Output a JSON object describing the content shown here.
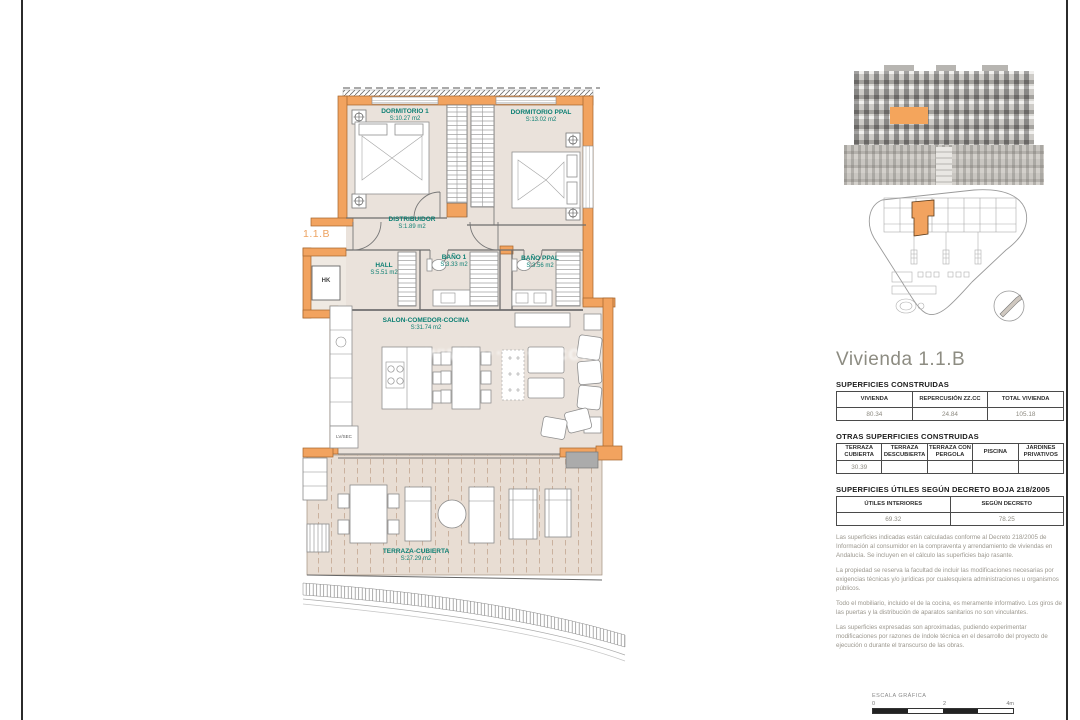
{
  "plan": {
    "unit_label": "1.1.B",
    "watermark": "www.·········.com",
    "rooms": [
      {
        "name": "DORMITORIO 1",
        "area": "S:10.27 m2"
      },
      {
        "name": "DORMITORIO PPAL",
        "area": "S:13.02 m2"
      },
      {
        "name": "DISTRIBUIDOR",
        "area": "S:1.89 m2"
      },
      {
        "name": "HALL",
        "area": "S:5.51 m2"
      },
      {
        "name": "BAÑO 1",
        "area": "S:3.33 m2"
      },
      {
        "name": "BAÑO PPAL",
        "area": "S:3.56 m2"
      },
      {
        "name": "SALON-COMEDOR-COCINA",
        "area": "S:31.74 m2"
      },
      {
        "name": "TERRAZA-CUBIERTA",
        "area": "S:27.29 m2"
      }
    ],
    "fixtures": {
      "hk": "HK",
      "lvsec": "LV/SEC"
    }
  },
  "panel": {
    "title": "Vivienda 1.1.B",
    "constructed": {
      "heading": "SUPERFICIES CONSTRUIDAS",
      "headers": [
        "VIVIENDA",
        "REPERCUSIÓN ZZ.CC",
        "TOTAL VIVIENDA"
      ],
      "values": [
        "80.34",
        "24.84",
        "105.18"
      ]
    },
    "other": {
      "heading": "OTRAS SUPERFICIES CONSTRUIDAS",
      "headers": [
        "TERRAZA CUBIERTA",
        "TERRAZA DESCUBIERTA",
        "TERRAZA CON PERGOLA",
        "PISCINA",
        "JARDINES PRIVATIVOS"
      ],
      "values": [
        "30.39",
        "",
        "",
        "",
        ""
      ]
    },
    "useful": {
      "heading": "SUPERFICIES ÚTILES SEGÚN DECRETO BOJA 218/2005",
      "headers": [
        "ÚTILES INTERIORES",
        "SEGÚN DECRETO"
      ],
      "values": [
        "69.32",
        "78.25"
      ]
    },
    "notes": [
      "Las superficies indicadas están calculadas conforme al Decreto 218/2005 de Información al consumidor en la compraventa y arrendamiento de viviendas en Andalucía. Se incluyen en el cálculo las superficies bajo rasante.",
      "La propiedad se reserva la facultad de incluir las modificaciones necesarias por exigencias técnicas y/o jurídicas por cualesquiera administraciones u organismos públicos.",
      "Todo el mobiliario, incluido el de la cocina, es meramente informativo. Los giros de las puertas y la distribución de aparatos sanitarios no son vinculantes.",
      "Las superficies expresadas son aproximadas, pudiendo experimentar modificaciones por razones de índole técnica en el desarrollo del proyecto de ejecución o durante el transcurso de las obras."
    ],
    "scale": {
      "label": "ESCALA GRÁFICA",
      "ticks": [
        "0",
        "2",
        "4m"
      ]
    }
  },
  "colors": {
    "accent_wall": "#f2a35f",
    "room_label": "#0c7f73",
    "floor": "#eae2db"
  }
}
